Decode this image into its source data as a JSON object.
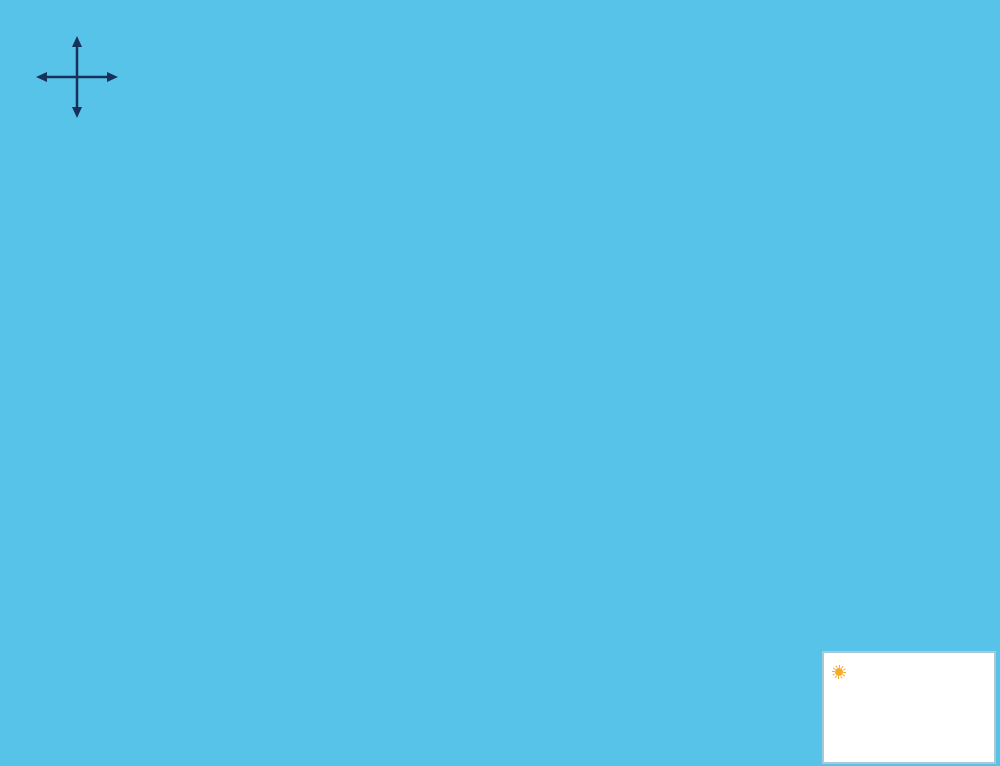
{
  "map": {
    "compass": {
      "top": "W",
      "right": "N",
      "left": "S",
      "bottom": "E"
    },
    "labels": {
      "gulf": "Gulf of Mexico",
      "beach": "BEACH",
      "boardwalk_top": "Boardwalk",
      "boardwalk_bottom": "Boardwalk",
      "waterway": "Waterway",
      "channel": "Blind Pass Channel"
    },
    "buildings": [
      {
        "label": "Building",
        "number": "11",
        "x": 862,
        "y": 86,
        "w": 150,
        "h": 72,
        "rot": -27,
        "labelRot": -27
      },
      {
        "label": "Building",
        "number": "10",
        "x": 737,
        "y": 183,
        "w": 112,
        "h": 92,
        "rot": -13,
        "labelRot": -13
      },
      {
        "label": "Building",
        "number": "9",
        "x": 566,
        "y": 294,
        "w": 112,
        "h": 88,
        "rot": -13,
        "labelRot": -13
      },
      {
        "label": "Building",
        "number": "8",
        "x": 460,
        "y": 366,
        "w": 112,
        "h": 84,
        "rot": -17,
        "labelRot": -17
      },
      {
        "label": "Building",
        "number": "7",
        "x": 346,
        "y": 437,
        "w": 112,
        "h": 84,
        "rot": -22,
        "labelRot": -22
      },
      {
        "label": "Building",
        "number": "6",
        "x": 231,
        "y": 507,
        "w": 112,
        "h": 84,
        "rot": -22,
        "labelRot": -22
      },
      {
        "label": "Building",
        "number": "5",
        "x": 262,
        "y": 628,
        "w": 115,
        "h": 78,
        "rot": 50,
        "labelRot": 70
      },
      {
        "label": "Building",
        "number": "4",
        "x": 416,
        "y": 571,
        "w": 108,
        "h": 72,
        "rot": -20,
        "labelRot": -20
      },
      {
        "label": "Building",
        "number": "3",
        "x": 547,
        "y": 523,
        "w": 125,
        "h": 76,
        "rot": -15,
        "labelRot": -15
      },
      {
        "label": "Building",
        "number": "1",
        "x": 775,
        "y": 342,
        "w": 180,
        "h": 52,
        "rot": -55,
        "labelRot": 57
      }
    ],
    "amenities": {
      "tennis": {
        "label": "Tennis Courts",
        "x": 900,
        "y": 170,
        "rot": -20
      },
      "pool": {
        "label": "Pool",
        "whirl_line1": "Whirl",
        "whirl_line2": "pool",
        "x": 655,
        "y": 250,
        "rot": -15
      },
      "swim": {
        "line1": "swim",
        "line2": "pool",
        "x": 318,
        "y": 631
      },
      "guard": {
        "line1": "Guard",
        "line2": "House",
        "x": 877,
        "y": 292
      },
      "shuffle": {
        "label": "Shuffle Board",
        "x": 713,
        "y": 441,
        "rot": -33
      },
      "volleyball": {
        "label1": "Volley",
        "label2": "Ball",
        "x": 657,
        "y": 452,
        "rot": -18
      },
      "bbq": {
        "label": "BBQ Grill",
        "x": 659,
        "y": 514,
        "rot": -17
      }
    },
    "info_box": {
      "name": "Land's End",
      "address1": "7500 Bayshore Drive",
      "address2": "Treasure Island, FL 33706"
    },
    "logo": {
      "mark": "R",
      "mark_small": "R",
      "name": "Resort Realty",
      "tagline": "Vacation Rentals & Sales"
    },
    "colors": {
      "water": "#57c3e8",
      "beach": "#ddd7a2",
      "grass": "#118a11",
      "ground": "#e9e9e9",
      "road": "#b9b9b9",
      "boardwalk_dark": "#55550f",
      "boardwalk_brick": "#b1a334",
      "building": "#ffffff",
      "building_shadow": "#c4c4c4",
      "building_stroke": "#777777",
      "tree": "#1b7a1b",
      "tree_stroke": "#0a4a0a",
      "roof_orange": "#cf7426",
      "roof_ridge": "#8a4a12",
      "label_blue": "#1f5f9e",
      "label_dark": "#2d2d3d",
      "pool_water": "#86d2f0",
      "whirl_water": "#5fb3dc",
      "teal": "#14a2a2",
      "address_blue": "#49b8dc",
      "sun": "#f7a928",
      "court_sand": "#d8d2a2"
    },
    "trees": [
      [
        937,
        60
      ],
      [
        917,
        88
      ],
      [
        900,
        108
      ],
      [
        860,
        127
      ],
      [
        820,
        142
      ],
      [
        800,
        168
      ],
      [
        757,
        255
      ],
      [
        855,
        230
      ],
      [
        893,
        242
      ],
      [
        925,
        223
      ],
      [
        957,
        218
      ],
      [
        978,
        238
      ],
      [
        848,
        316
      ],
      [
        862,
        332
      ],
      [
        943,
        318
      ],
      [
        920,
        350
      ],
      [
        810,
        268
      ],
      [
        833,
        336
      ],
      [
        820,
        357
      ],
      [
        806,
        378
      ],
      [
        790,
        400
      ],
      [
        772,
        416
      ],
      [
        718,
        384
      ],
      [
        722,
        462
      ],
      [
        750,
        432
      ],
      [
        746,
        218
      ],
      [
        726,
        250
      ],
      [
        685,
        270
      ],
      [
        660,
        288
      ],
      [
        640,
        300
      ],
      [
        612,
        310
      ],
      [
        640,
        330
      ],
      [
        625,
        308
      ],
      [
        505,
        388
      ],
      [
        455,
        422
      ],
      [
        415,
        418
      ],
      [
        428,
        480
      ],
      [
        493,
        497
      ],
      [
        523,
        478
      ],
      [
        555,
        477
      ],
      [
        622,
        490
      ],
      [
        588,
        465
      ],
      [
        440,
        590
      ],
      [
        395,
        462
      ],
      [
        348,
        483
      ],
      [
        275,
        530
      ],
      [
        230,
        550
      ],
      [
        193,
        572
      ],
      [
        412,
        498
      ],
      [
        360,
        540
      ],
      [
        336,
        568
      ],
      [
        288,
        570
      ],
      [
        308,
        602
      ],
      [
        225,
        650
      ],
      [
        365,
        648
      ],
      [
        335,
        665
      ],
      [
        150,
        597
      ]
    ]
  }
}
